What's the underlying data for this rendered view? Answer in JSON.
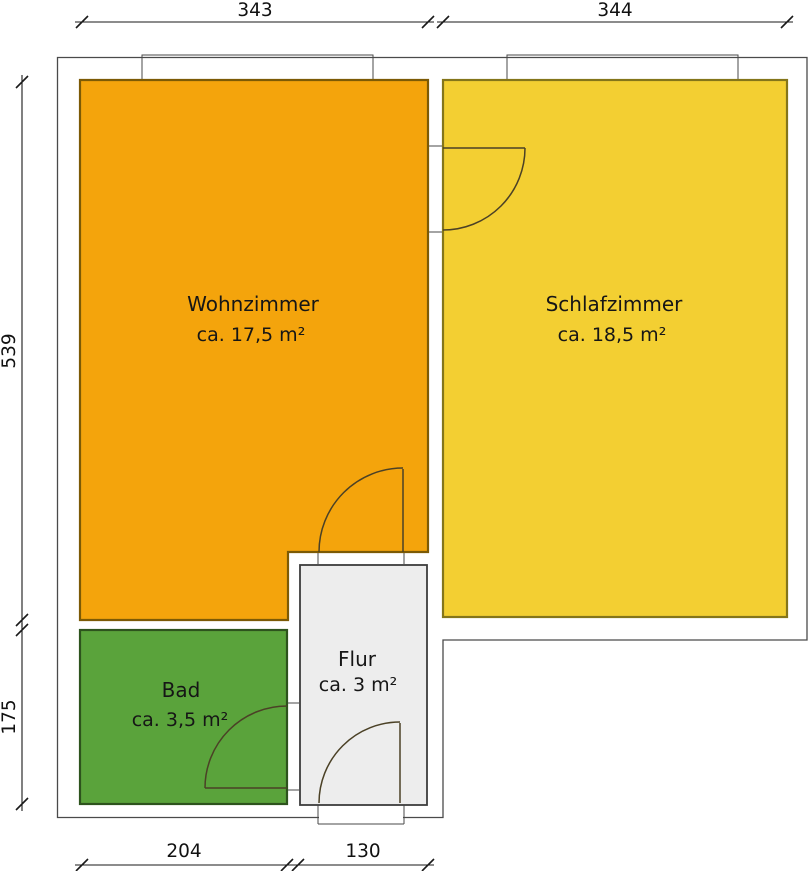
{
  "floor_plan": {
    "rooms": [
      {
        "name": "Wohnzimmer",
        "area": "ca. 17,5 m²",
        "fill": "#F4A40C",
        "border": "#7C5A05"
      },
      {
        "name": "Schlafzimmer",
        "area": "ca. 18,5 m²",
        "fill": "#F3CF32",
        "border": "#84751A"
      },
      {
        "name": "Bad",
        "area": "ca. 3,5 m²",
        "fill": "#5AA33B",
        "border": "#2D531D"
      },
      {
        "name": "Flur",
        "area": "ca. 3 m²",
        "fill": "#EDEDED",
        "border": "#3C3C3C"
      }
    ],
    "dimensions_cm": {
      "top_wohnzimmer": "343",
      "top_schlafzimmer": "344",
      "left_wohnzimmer": "539",
      "left_bad": "175",
      "bottom_bad": "204",
      "bottom_flur": "130"
    },
    "colors": {
      "ink": "#1A1A1A",
      "wall_outline": "#4A4A4A",
      "door_symbol": "#4B4126",
      "window_fill": "#FFFFFF"
    }
  }
}
